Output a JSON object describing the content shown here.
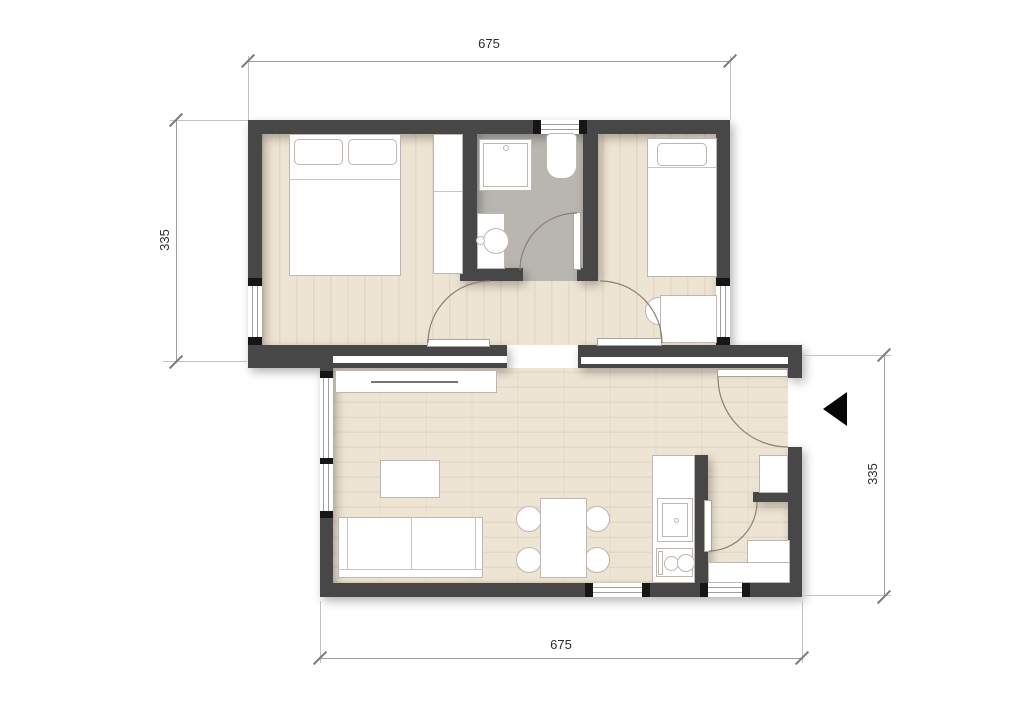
{
  "title": "apartment-floor-plan",
  "dimensions": {
    "top": "675",
    "bottom": "675",
    "left": "335",
    "right": "335"
  },
  "colors": {
    "wall": "#474747",
    "floor_wood": "#eee4d3",
    "floor_bathroom": "#b9b6b1",
    "entrance_arrow": "#060606",
    "dimension_line": "#9d9d9d",
    "furniture_fill": "#ffffff",
    "door_arc": "#8d7f70"
  },
  "icons": {
    "entrance_marker": "left-pointing-triangle"
  },
  "structure": {
    "rooms": [
      "bedroom-left",
      "bathroom",
      "bedroom-right",
      "living-dining-kitchen",
      "entry-hall",
      "storage"
    ],
    "furniture": [
      "double-bed",
      "wardrobe",
      "shower",
      "toilet",
      "washbasin",
      "single-bed",
      "desk-with-chair",
      "tv-sideboard",
      "coffee-table",
      "sofa",
      "dining-table",
      "dining-chairs",
      "kitchen-counter",
      "kitchen-sink",
      "cooktop",
      "entry-cabinet",
      "storage-counter"
    ],
    "doors": [
      "bedroom-left-door",
      "bedroom-right-door",
      "bathroom-door",
      "entrance-door",
      "storage-door"
    ],
    "windows": 6
  }
}
